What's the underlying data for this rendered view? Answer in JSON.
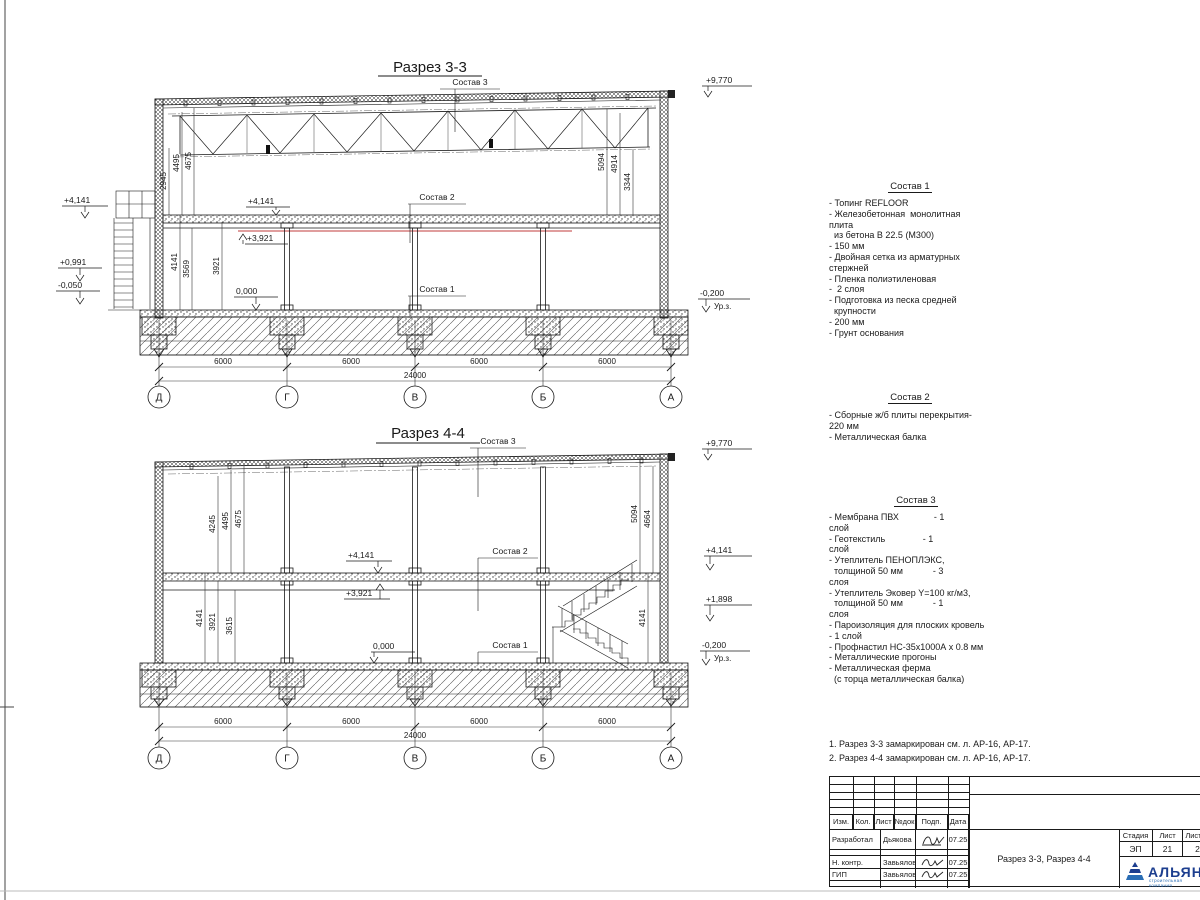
{
  "s33": {
    "title": "Разрез 3-3",
    "callouts": {
      "c1": "Состав 1",
      "c2": "Состав 2",
      "c3": "Состав 3"
    },
    "elev": {
      "top": "+9,770",
      "l1": "+4,141",
      "l2": "+0,991",
      "l3": "-0,050",
      "i1": "+4,141",
      "i2": "+3,921",
      "i0": "0,000",
      "r1": "-0,200",
      "urz": "Ур.з."
    },
    "dims_lu": [
      "2945",
      "4495",
      "4675"
    ],
    "dims_ll": [
      "4141",
      "3569",
      "3921"
    ],
    "dims_r": [
      "5094",
      "4914",
      "3344"
    ],
    "spans": [
      "6000",
      "6000",
      "6000",
      "6000"
    ],
    "total": "24000",
    "axes": [
      "Д",
      "Г",
      "В",
      "Б",
      "А"
    ]
  },
  "s44": {
    "title": "Разрез 4-4",
    "callouts": {
      "c1": "Состав 1",
      "c2": "Состав 2",
      "c3": "Состав 3"
    },
    "elev": {
      "top": "+9,770",
      "i1": "+4,141",
      "i2": "+3,921",
      "i0": "0,000",
      "r1": "+4,141",
      "r2": "+1,898",
      "r3": "-0,200",
      "urz": "Ур.з."
    },
    "dims_lu": [
      "4245",
      "4495",
      "4675"
    ],
    "dims_ll": [
      "4141",
      "3921",
      "3615"
    ],
    "dims_ru": [
      "5094",
      "4664"
    ],
    "dim_rl": "4141",
    "spans": [
      "6000",
      "6000",
      "6000",
      "6000"
    ],
    "total": "24000",
    "axes": [
      "Д",
      "Г",
      "В",
      "Б",
      "А"
    ]
  },
  "notes": {
    "sostav1": {
      "heading": "Состав 1",
      "lines": [
        "- Топинг REFLOOR",
        "- Железобетонная  монолитная",
        "плита",
        "  из бетона В 22.5 (М300)",
        "- 150 мм",
        "- Двойная сетка из арматурных",
        "стержней",
        "- Пленка полиэтиленовая",
        "-  2 слоя",
        "- Подготовка из песка средней",
        "  крупности",
        "- 200 мм",
        "- Грунт основания"
      ]
    },
    "sostav2": {
      "heading": "Состав 2",
      "lines": [
        "- Сборные ж/б плиты перекрытия-",
        "220 мм",
        "- Металлическая балка"
      ]
    },
    "sostav3": {
      "heading": "Состав 3",
      "lines": [
        "- Мембрана ПВХ              - 1",
        "слой",
        "- Геотекстиль               - 1",
        "слой",
        "- Утеплитель ПЕНОПЛЭКС,",
        "  толщиной 50 мм            - 3",
        "слоя",
        "- Утеплитель Эковер Y=100 кг/м3,",
        "  толщиной 50 мм            - 1",
        "слоя",
        "- Пароизоляция для плоских кровель",
        "- 1 слой",
        "- Профнастил НС-35х1000А х 0.8 мм",
        "- Металлические прогоны",
        "- Металлическая ферма",
        "  (с торца металлическая балка)"
      ]
    }
  },
  "footnotes": [
    "1. Разрез 3-3 замаркирован см. л. АР-16, АР-17.",
    "2. Разрез 4-4 замаркирован см. л. АР-16, АР-17."
  ],
  "titleblock": {
    "header_cols": [
      "Изм.",
      "Кол.",
      "Лист",
      "№док",
      "Подп.",
      "Дата"
    ],
    "rows": [
      {
        "role": "Разработал",
        "name": "Дьякова",
        "date": "07.25"
      },
      {
        "role": "Н. контр.",
        "name": "Завьялова",
        "date": "07.25"
      },
      {
        "role": "ГИП",
        "name": "Завьялова",
        "date": "07.25"
      }
    ],
    "doc_title": "Разрез 3-3, Разрез 4-4",
    "stage_label": "Стадия",
    "sheet_label": "Лист",
    "sheets_label": "Листов",
    "stage_value": "ЭП",
    "sheet_value": "21",
    "sheets_value": "2",
    "company": "АЛЬЯНС",
    "company_sub": "строительная компания",
    "logo_color": "#1c3e8f"
  }
}
